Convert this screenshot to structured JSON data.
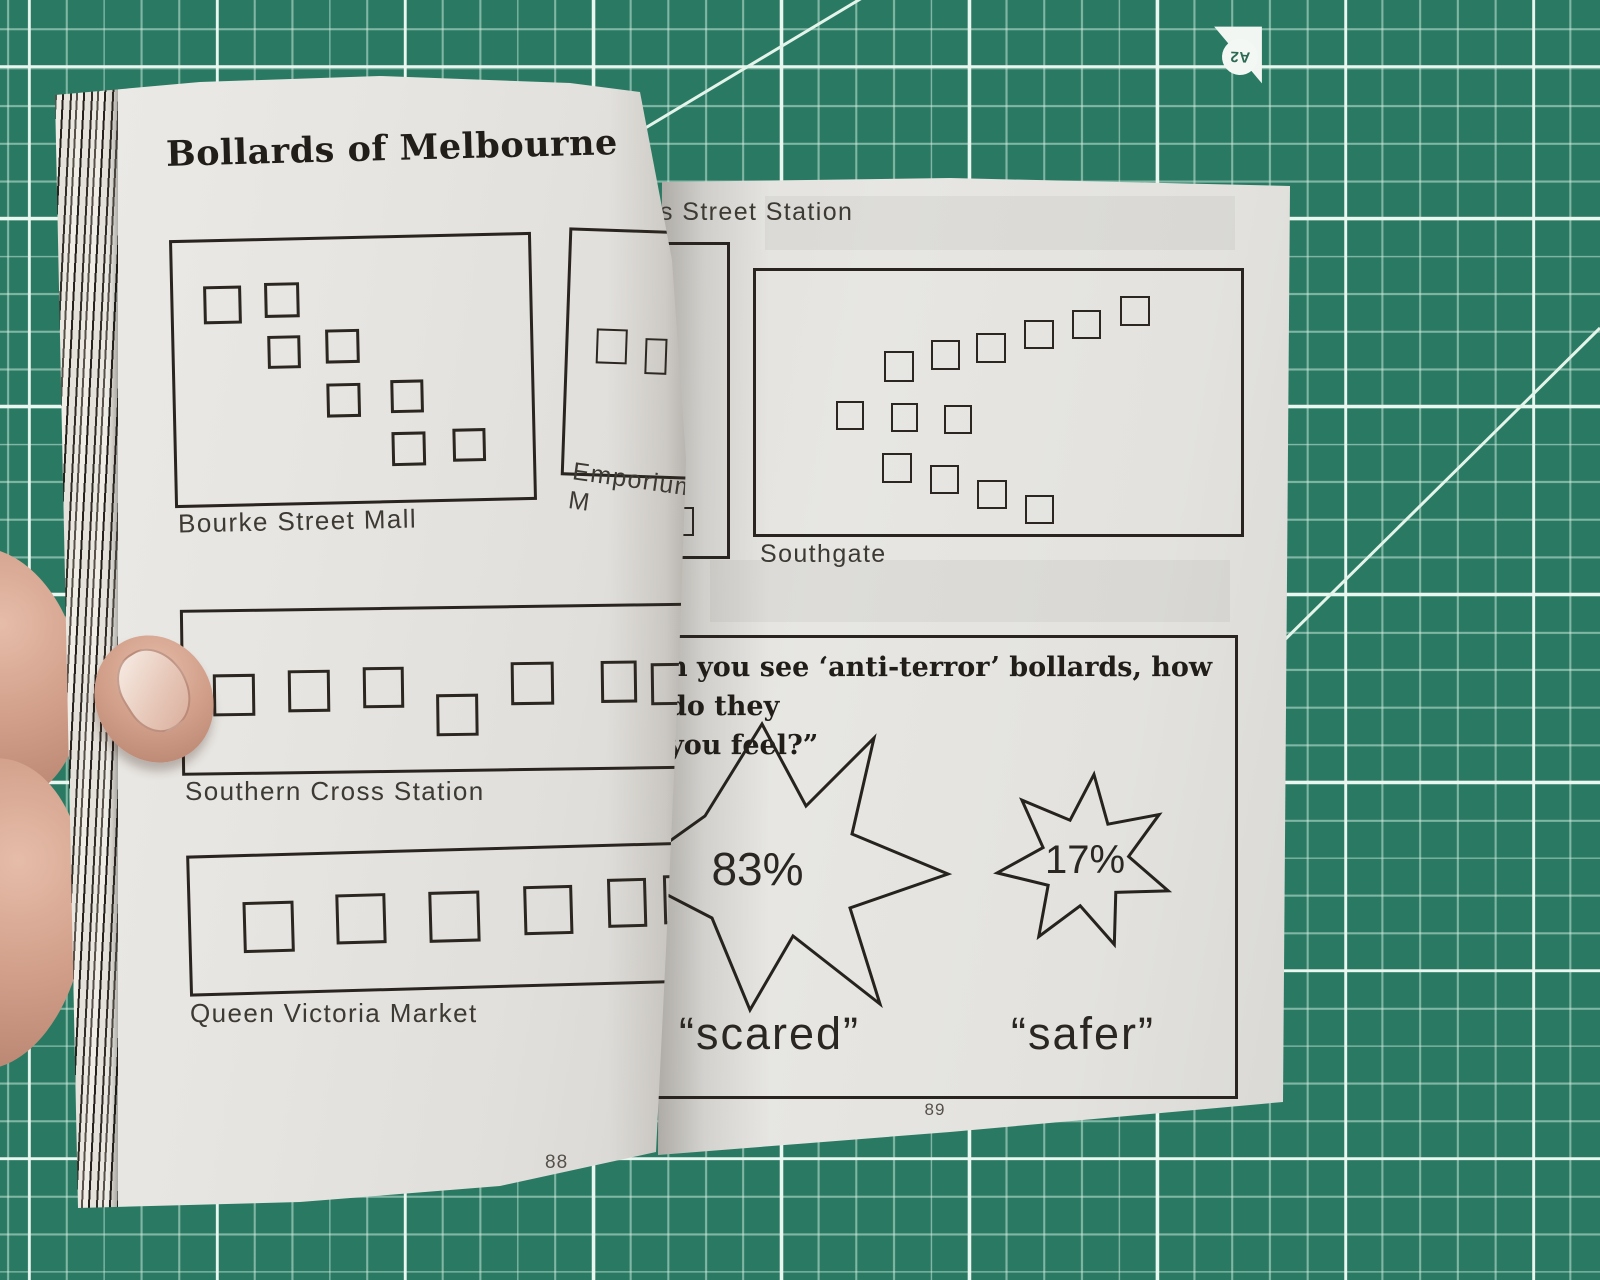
{
  "mat": {
    "corner_marker": "A2"
  },
  "book": {
    "left_page": {
      "title": "Bollards of Melbourne",
      "page_number": "88",
      "diagrams": [
        {
          "label": "Bourke Street Mall",
          "bollard_count": 8
        },
        {
          "label": "Emporium M",
          "bollard_count": 2
        },
        {
          "label": "Southern Cross Station",
          "bollard_count": 7
        },
        {
          "label": "Queen Victoria Market",
          "bollard_count": 6
        }
      ]
    },
    "right_page": {
      "page_number": "89",
      "diagrams": [
        {
          "label": "s Street Station",
          "bollard_count": 2
        },
        {
          "label": "Southgate",
          "bollard_count": 13
        }
      ],
      "survey": {
        "question_line1": "n you see ‘anti-terror’ bollards, how do they",
        "question_line2": "you feel?”",
        "results": [
          {
            "value": "83%",
            "label": "“scared”"
          },
          {
            "value": "17%",
            "label": "“safer”"
          }
        ]
      }
    }
  }
}
